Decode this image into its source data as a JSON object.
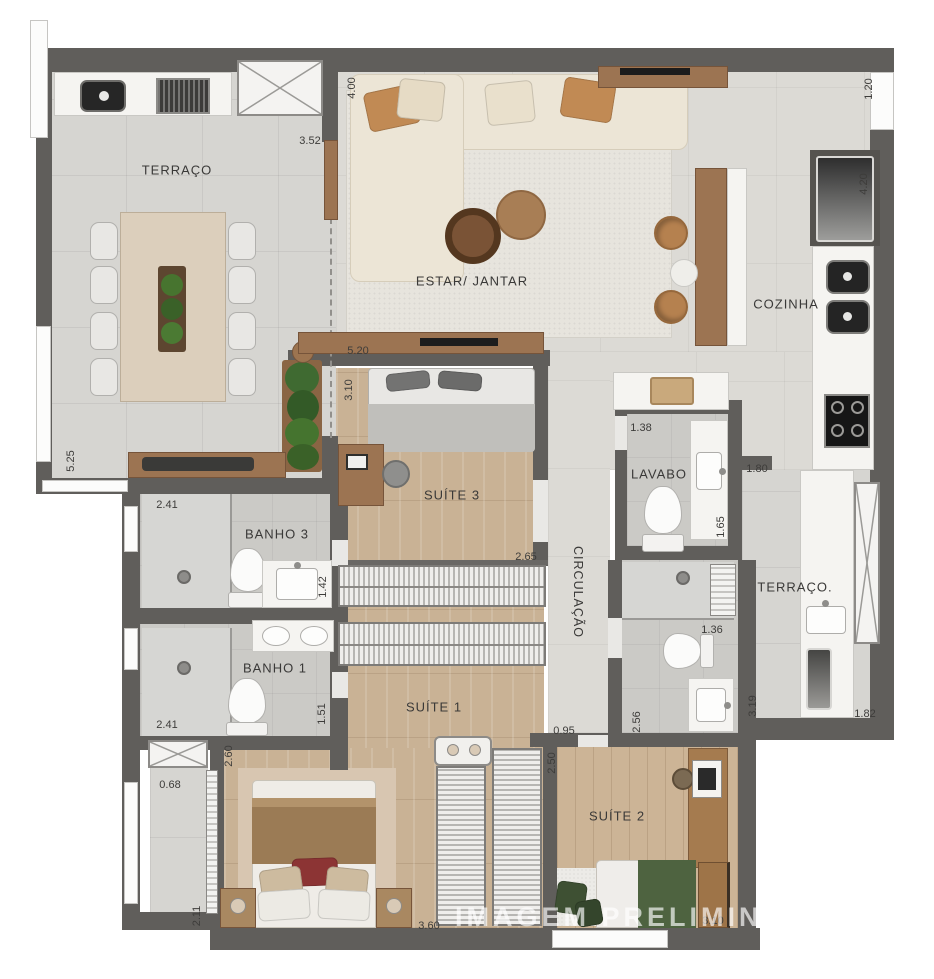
{
  "watermark": "IMAGEM PRELIMINAR",
  "rooms": {
    "terraco_left": "TERRAÇO",
    "estar_jantar": "ESTAR/ JANTAR",
    "cozinha": "COZINHA",
    "lavabo": "LAVABO",
    "terraco_right": "TERRAÇO.",
    "circulacao": "CIRCULAÇÃO",
    "suite_3": "SUÍTE 3",
    "banho_3": "BANHO 3",
    "banho_1": "BANHO 1",
    "suite_1": "SUÍTE 1",
    "suite_2": "SUÍTE 2"
  },
  "dims": {
    "d01": "3.52",
    "d02": "4.00",
    "d03": "1.20",
    "d04": "4.20",
    "d05": "5.20",
    "d06": "3.10",
    "d07": "5.25",
    "d08": "1.38",
    "d09": "1.80",
    "d10": "1.65",
    "d11": "2.41",
    "d12": "1.42",
    "d13": "2.65",
    "d14": "2.41",
    "d15": "1.51",
    "d16": "2.60",
    "d17": "0.68",
    "d18": "2.11",
    "d19": "3.60",
    "d20": "2.50",
    "d21": "0.95",
    "d22": "2.56",
    "d23": "1.36",
    "d24": "3.19",
    "d25": "1.82",
    "d26": "3.10"
  },
  "colors": {
    "wall": "#605e5b",
    "tile_floor": "#d6d5d1",
    "wood_floor": "#c9b295",
    "sofa": "#ece5d6",
    "accent_wood": "#9c7452",
    "plant_green": "#3f6a31",
    "suite1_blanket": "#9b7b55",
    "red_pillow": "#8c3434",
    "suite2_blanket": "#4e6340",
    "watermark_text": "#ffffff"
  }
}
